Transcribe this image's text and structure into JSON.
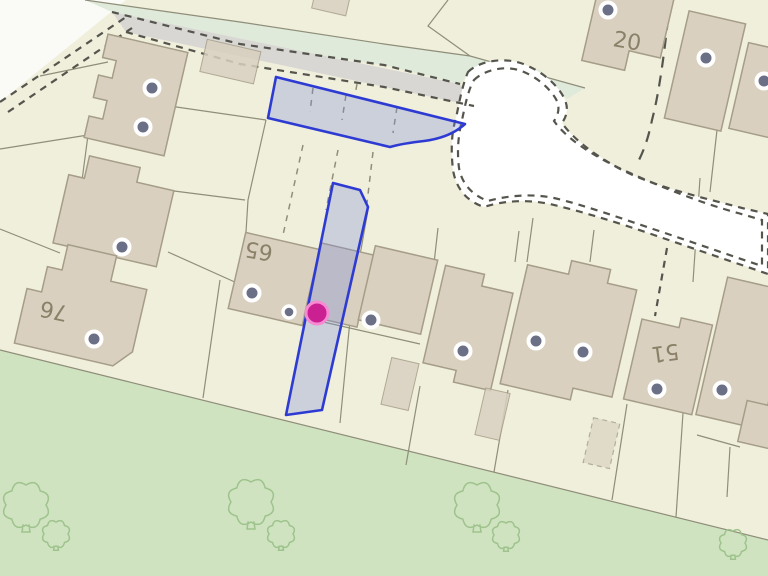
{
  "map": {
    "colors": {
      "background": "#f0efdc",
      "outside": "#fafaf7",
      "field": "#cfe3c1",
      "verge": "#dfeada",
      "road": "#d8d7d3",
      "water_track": "#ffffff",
      "building_fill": "#d9d0c0",
      "building_stroke": "#a59d87",
      "parcel_line": "#8f8e79",
      "boundary_dash": "#55554d",
      "selection_stroke": "#2e3bd3",
      "selection_fill": "rgba(120,135,220,0.30)",
      "marker_fill": "#6b7087",
      "marker_ring": "#ffffff",
      "selected_marker_fill": "#cb2092",
      "selected_marker_ring": "#f78ad2",
      "label_text": "#8a8168",
      "tree_stroke": "#9fc38c"
    },
    "house_number_labels": [
      {
        "text": "20",
        "x": 627,
        "y": 42,
        "rotation": 10
      },
      {
        "text": "65",
        "x": 259,
        "y": 250,
        "rotation": 190
      },
      {
        "text": "76",
        "x": 54,
        "y": 310,
        "rotation": 192
      },
      {
        "text": "51",
        "x": 665,
        "y": 352,
        "rotation": 172
      }
    ],
    "address_markers": [
      {
        "x": 152,
        "y": 88
      },
      {
        "x": 143,
        "y": 127
      },
      {
        "x": 122,
        "y": 247
      },
      {
        "x": 94,
        "y": 339
      },
      {
        "x": 252,
        "y": 293
      },
      {
        "x": 289,
        "y": 312,
        "small": true
      },
      {
        "x": 371,
        "y": 320
      },
      {
        "x": 463,
        "y": 351
      },
      {
        "x": 536,
        "y": 341
      },
      {
        "x": 583,
        "y": 352
      },
      {
        "x": 657,
        "y": 389
      },
      {
        "x": 722,
        "y": 390
      },
      {
        "x": 608,
        "y": 10
      },
      {
        "x": 706,
        "y": 58
      },
      {
        "x": 764,
        "y": 81
      }
    ],
    "selected_point": {
      "x": 317,
      "y": 313
    },
    "trees": [
      {
        "x": 26,
        "y": 505,
        "size": 20
      },
      {
        "x": 56,
        "y": 534,
        "size": 12
      },
      {
        "x": 251,
        "y": 502,
        "size": 20
      },
      {
        "x": 281,
        "y": 534,
        "size": 12
      },
      {
        "x": 477,
        "y": 505,
        "size": 20
      },
      {
        "x": 506,
        "y": 535,
        "size": 12
      },
      {
        "x": 733,
        "y": 543,
        "size": 12
      }
    ]
  }
}
